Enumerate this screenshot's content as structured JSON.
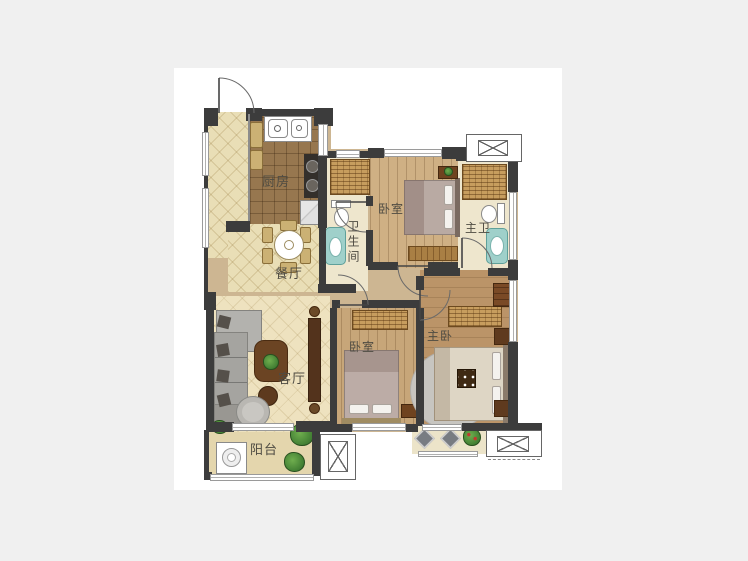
{
  "canvas": {
    "background_color": "#f0f0f0",
    "page_color": "#ffffff",
    "wall_color": "#3c3c3c",
    "label_color": "#4e4b42",
    "accent_teal": "#9fd0ca",
    "wood_floor": "#c9a87c",
    "tile_floor": "#e9deb6",
    "wardrobe_fill": "#c79d5e"
  },
  "floorplan": {
    "type": "residential-unit-plan",
    "labels": {
      "kitchen": "厨房",
      "dining": "餐厅",
      "bathroom": "卫生间",
      "bedroom_top": "卧室",
      "master_bathroom": "主卫",
      "living_room": "客厅",
      "bedroom_bottom": "卧室",
      "master_bedroom": "主卧",
      "balcony": "阳台"
    },
    "symbols": [
      "ac-outdoor-unit",
      "door-swing",
      "window",
      "wardrobe-hatch",
      "double-sink",
      "stove",
      "fridge",
      "dining-table",
      "toilet",
      "bathtub",
      "shower",
      "sofa",
      "coffee-table",
      "armchair",
      "tv-cabinet",
      "bed",
      "nightstand",
      "rug",
      "washing-machine",
      "plant",
      "cushion"
    ]
  }
}
